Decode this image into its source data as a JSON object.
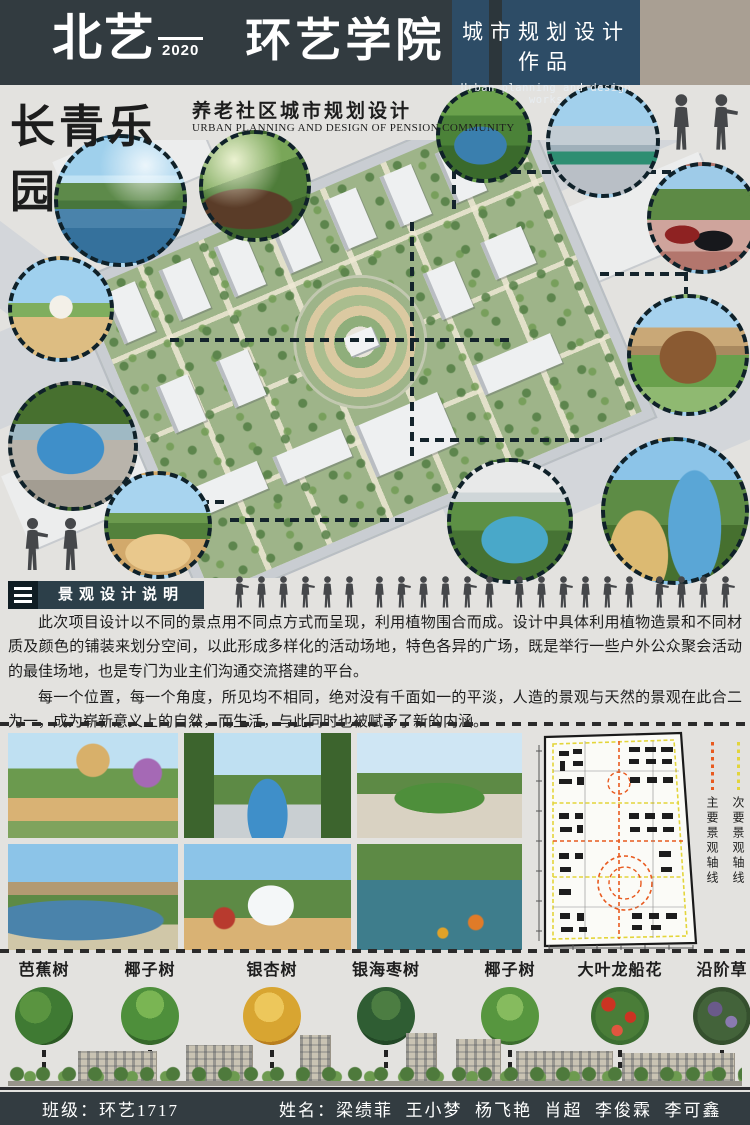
{
  "header": {
    "logo_cn": "北艺",
    "logo_year": "2020",
    "logo_dept": "环艺学院",
    "title_cn": "城市规划设计作品",
    "title_en": "Urban planning and design works"
  },
  "title": {
    "main": "长青乐园",
    "sub_cn": "养老社区城市规划设计",
    "sub_en": "URBAN PLANNING AND DESIGN OF PENSION COMMUNITY"
  },
  "section": {
    "heading": "景观设计说明"
  },
  "description": {
    "para1": "此次项目设计以不同的景点用不同点方式而呈现，利用植物围合而成。设计中具体利用植物造景和不同材质及颜色的铺装来划分空间，以此形成多样化的活动场地，特色各异的广场，既是举行一些户外公众聚会活动的最佳场地，也是专门为业主们沟通交流搭建的平台。",
    "para2": "每一个位置，每一个角度，所见均不相同，绝对没有千面如一的平淡，人造的景观与天然的景观在此合二为一，成为崭新意义上的自然，而生活，与此同时也被赋予了新的内涵。"
  },
  "plan_legend": {
    "primary": "主要景观轴线",
    "secondary": "次要景观轴线"
  },
  "plants": [
    {
      "name": "芭蕉树"
    },
    {
      "name": "椰子树"
    },
    {
      "name": "银杏树"
    },
    {
      "name": "银海枣树"
    },
    {
      "name": "椰子树"
    },
    {
      "name": "大叶龙船花"
    },
    {
      "name": "沿阶草"
    }
  ],
  "footer": {
    "class_label": "班级：环艺1717",
    "names_label": "姓名：梁绩菲  王小梦  杨飞艳  肖超  李俊霖  李可鑫"
  }
}
